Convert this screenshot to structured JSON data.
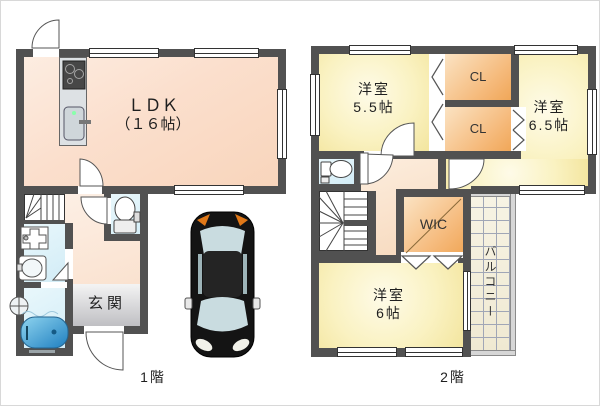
{
  "floor1": {
    "label": "1階",
    "ldk": {
      "name": "ＬＤＫ",
      "size": "（１６帖）"
    },
    "genkan": {
      "label": "玄関"
    },
    "fixtures": [
      "kitchen-stove-icon",
      "kitchen-sink-icon",
      "toilet-icon",
      "washing-machine-pan-icon",
      "washbasin-icon",
      "bathtub-icon",
      "shower-icon",
      "staircase-icon",
      "door-swing-icon",
      "window-icon",
      "car-icon"
    ]
  },
  "floor2": {
    "label": "2階",
    "bedroom_a": {
      "name": "洋室",
      "size": "5.5帖"
    },
    "bedroom_b": {
      "name": "洋室",
      "size": "6.5帖"
    },
    "bedroom_c": {
      "name": "洋室",
      "size": "6帖"
    },
    "closet1": {
      "label": "CL"
    },
    "closet2": {
      "label": "CL"
    },
    "wic": {
      "label": "WIC"
    },
    "balcony": {
      "label": "バルコニー"
    },
    "fixtures": [
      "toilet-icon",
      "staircase-icon",
      "folding-door-icon",
      "door-swing-icon",
      "window-icon"
    ]
  },
  "colors": {
    "wall": "#515151",
    "ldk": "#f9d8c0",
    "bedroom": "#f8edb5",
    "closet": "#f2ab60",
    "water_rooms": "#ddf1f8",
    "genkan": "#cccccc",
    "balcony": "#f2eedb",
    "tub": "#2f8fc4",
    "car_signal": "#e07818"
  }
}
